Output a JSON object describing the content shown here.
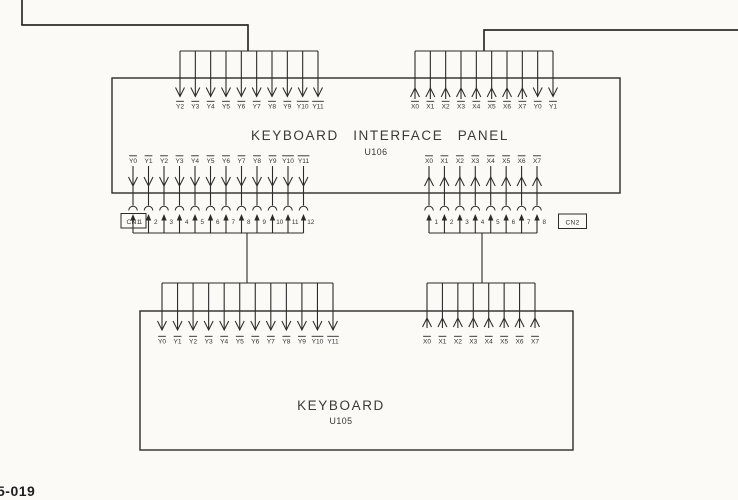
{
  "page": {
    "background": "#fbfaf6",
    "line_color": "#2b2b2b",
    "text_color": "#353535",
    "corner_label": "5-019"
  },
  "panel": {
    "title": "KEYBOARD INTERFACE PANEL",
    "ref": "U106",
    "top_left_pins": {
      "overline": true,
      "arrow": "into-panel",
      "labels": [
        "Y2",
        "Y3",
        "Y4",
        "Y5",
        "Y6",
        "Y7",
        "Y8",
        "Y9",
        "Y10",
        "Y11"
      ]
    },
    "top_right_pins": {
      "overline": true,
      "labels": [
        "X0",
        "X1",
        "X2",
        "X3",
        "X4",
        "X5",
        "X6",
        "X7",
        "Y0",
        "Y1"
      ],
      "arrows": [
        "out",
        "out",
        "out",
        "out",
        "out",
        "out",
        "out",
        "out",
        "in",
        "in"
      ]
    },
    "bottom_left_pins": {
      "overline": true,
      "arrow": "out-of-panel",
      "labels": [
        "Y0",
        "Y1",
        "Y2",
        "Y3",
        "Y4",
        "Y5",
        "Y6",
        "Y7",
        "Y8",
        "Y9",
        "Y10",
        "Y11"
      ]
    },
    "bottom_right_pins": {
      "overline": true,
      "arrow": "into-panel",
      "labels": [
        "X0",
        "X1",
        "X2",
        "X3",
        "X4",
        "X5",
        "X6",
        "X7"
      ]
    }
  },
  "connectors": {
    "cn1": {
      "label": "CN1",
      "pin_numbers": [
        "1",
        "2",
        "3",
        "4",
        "5",
        "6",
        "7",
        "8",
        "9",
        "10",
        "11",
        "12"
      ]
    },
    "cn2": {
      "label": "CN2",
      "pin_numbers": [
        "1",
        "2",
        "3",
        "4",
        "5",
        "6",
        "7",
        "8"
      ]
    }
  },
  "keyboard": {
    "title": "KEYBOARD",
    "ref": "U105",
    "left_pins": {
      "overline": true,
      "arrow": "into-keyboard",
      "labels": [
        "Y0",
        "Y1",
        "Y2",
        "Y3",
        "Y4",
        "Y5",
        "Y6",
        "Y7",
        "Y8",
        "Y9",
        "Y10",
        "Y11"
      ]
    },
    "right_pins": {
      "overline": true,
      "arrow": "out-of-keyboard",
      "labels": [
        "X0",
        "X1",
        "X2",
        "X3",
        "X4",
        "X5",
        "X6",
        "X7"
      ]
    }
  }
}
